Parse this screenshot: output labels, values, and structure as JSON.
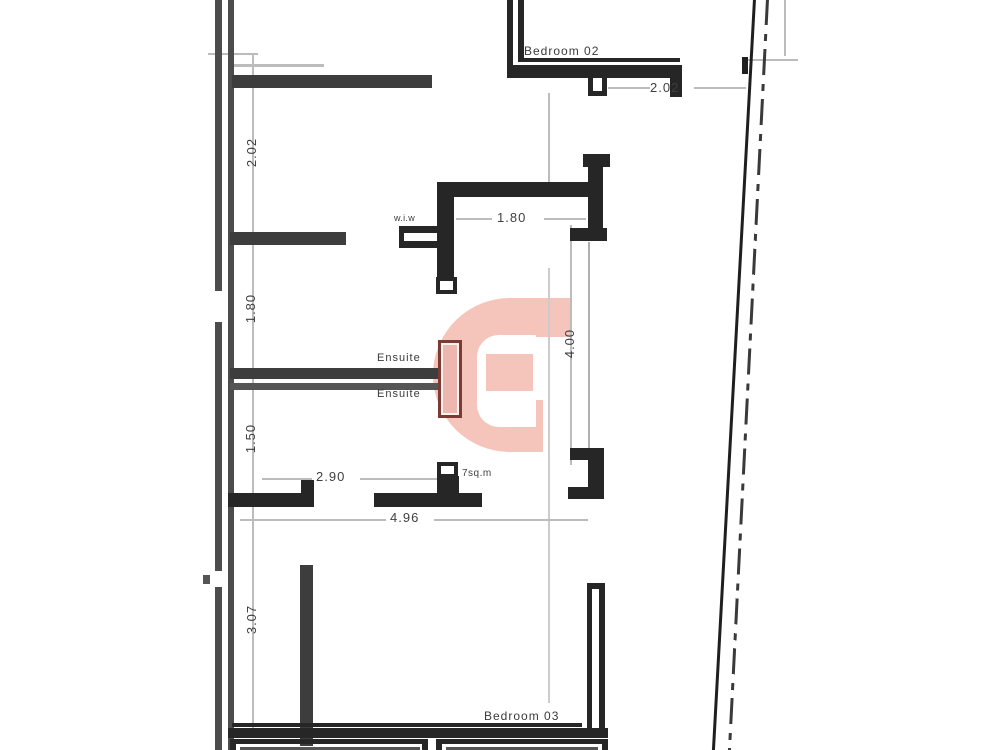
{
  "plan": {
    "title": "apartment-floor-plan",
    "rooms": {
      "bedroom02": "Bedroom 02",
      "bedroom03": "Bedroom 03",
      "ensuite_upper": "Ensuite",
      "ensuite_lower": "Ensuite",
      "wiw": "w.i.w",
      "area_label": "7sq.m"
    },
    "dims": {
      "left_202": "2.02",
      "left_180": "1.80",
      "left_150": "1.50",
      "left_307": "3.07",
      "top_202": "2.02",
      "center_180": "1.80",
      "center_400": "4.00",
      "center_290": "2.90",
      "center_496": "4.96"
    },
    "colors": {
      "background": "#ffffff",
      "wall_dark": "#262626",
      "wall_mid": "#3d3d3d",
      "boundary_gray": "#4c4c4c",
      "thin_line": "#bcbcbc",
      "logo_pink": "#f5c4bb",
      "door_red": "#7b3a33",
      "text": "#3f3f3f"
    }
  }
}
